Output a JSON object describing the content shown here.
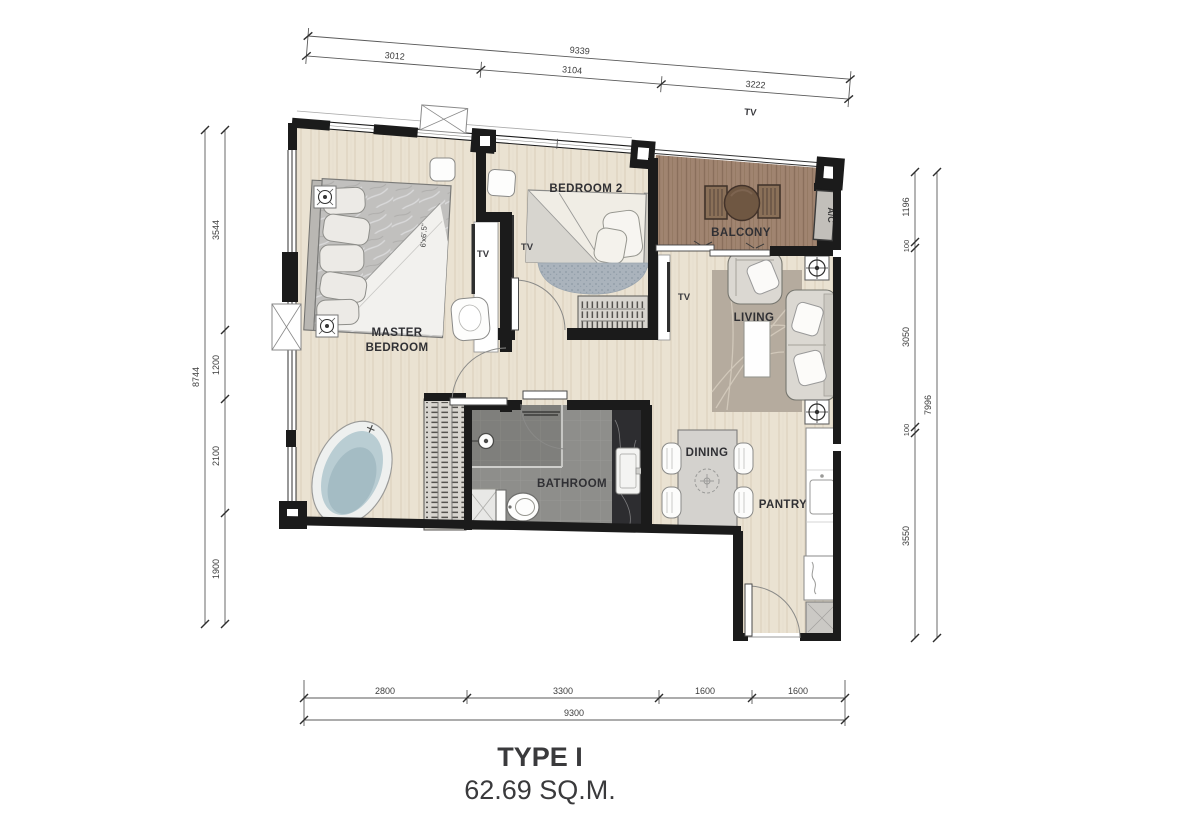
{
  "title": {
    "type": "TYPE I",
    "area": "62.69 SQ.M."
  },
  "rooms": {
    "master_line1": "MASTER",
    "master_line2": "BEDROOM",
    "bedroom2": "BEDROOM 2",
    "balcony": "BALCONY",
    "living": "LIVING",
    "dining": "DINING",
    "pantry": "PANTRY",
    "bathroom": "BATHROOM",
    "ac_unit": "A/C"
  },
  "labels": {
    "tv": "TV",
    "master_bed_size": "6'x6'.5\""
  },
  "dims": {
    "top": {
      "overall": "9339",
      "segments": [
        "3012",
        "3104",
        "3222"
      ]
    },
    "left": {
      "overall": "8744",
      "segments": [
        "3544",
        "1200",
        "2100",
        "1900"
      ]
    },
    "right": {
      "overall": "7996",
      "segments": [
        "1196",
        "100",
        "3050",
        "100",
        "3550"
      ]
    },
    "bottom": {
      "overall": "9300",
      "segments": [
        "2800",
        "3300",
        "1600",
        "1600"
      ]
    }
  },
  "colors": {
    "wall": "#1b1b1b",
    "floor_wood": "#eae2d2",
    "balcony_wood": "#a08470",
    "bathroom_tile": "#8e8e8b",
    "marble_dark": "#2d2d30",
    "dim_text": "#3d3d3d"
  }
}
